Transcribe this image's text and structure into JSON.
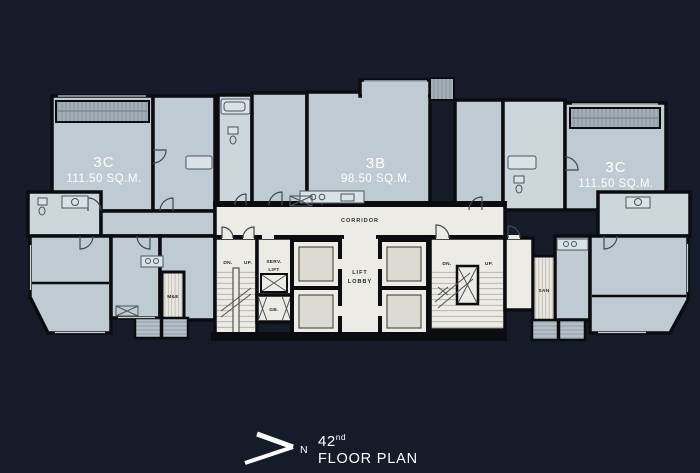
{
  "colors": {
    "background": "#161b29",
    "room_fill": "#becbd2",
    "room_fill_light": "#ccd7dc",
    "balcony_fill": "#a3b0b7",
    "core_fill": "#edebe5",
    "wall": "#0b0c0f",
    "label_light": "#ffffff",
    "label_dark": "#26292e"
  },
  "units": [
    {
      "name": "3C",
      "area": "111.50 SQ.M."
    },
    {
      "name": "3B",
      "area": "98.50 SQ.M."
    },
    {
      "name": "3C",
      "area": "111.50 SQ.M."
    }
  ],
  "core": {
    "corridor": "CORRIDOR",
    "lift_lobby_line1": "LIFT",
    "lift_lobby_line2": "LOBBY",
    "serv_lift_line1": "SERV.",
    "serv_lift_line2": "LIFT",
    "gb": "GB.",
    "me": "M&E",
    "san": "SAN",
    "stairs": {
      "dn": "DN.",
      "up": "UP."
    }
  },
  "title": {
    "floor_number": "42",
    "floor_suffix": "nd",
    "floor_label": "FLOOR PLAN",
    "north": "N"
  }
}
